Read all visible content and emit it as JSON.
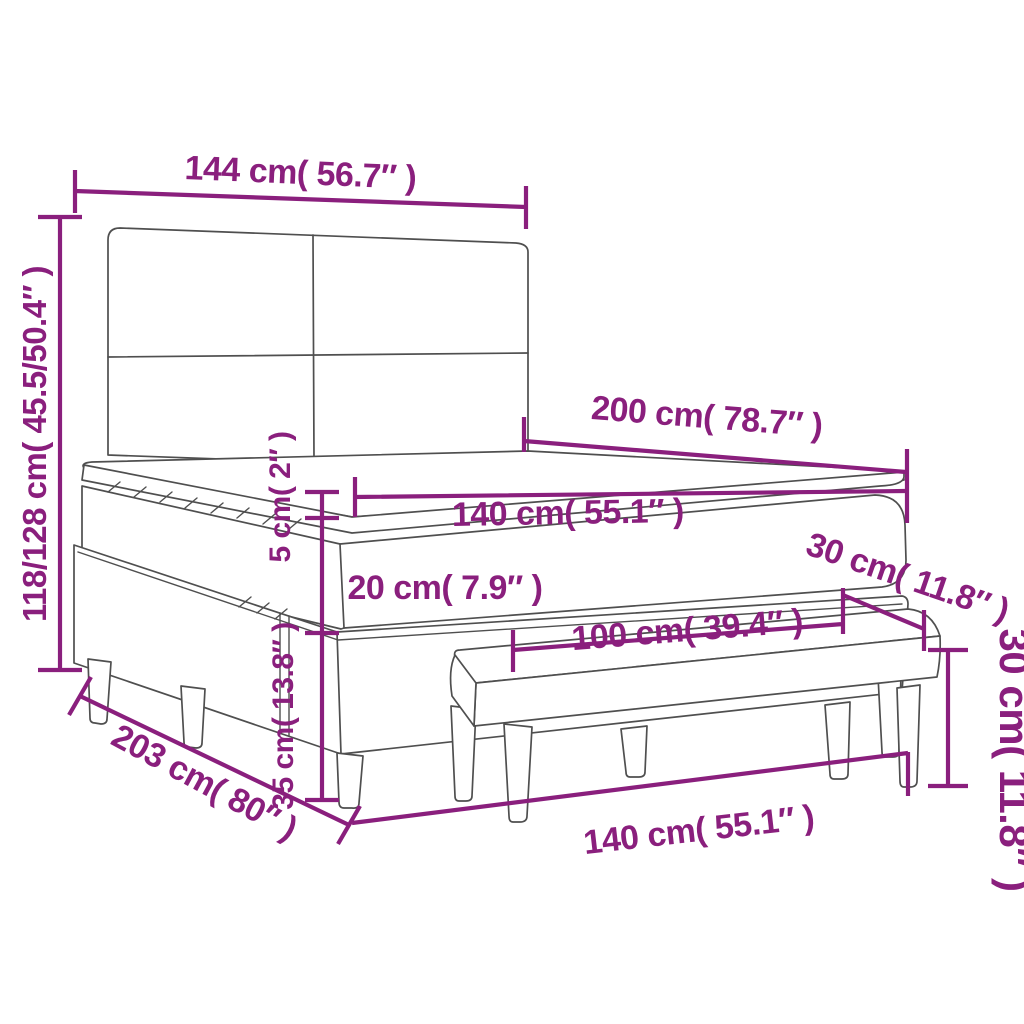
{
  "colors": {
    "annotation": "#8a1f7d",
    "line_art": "#4f4f4f",
    "background": "#ffffff"
  },
  "dims": {
    "headboard_width": "144 cm( 56.7″ )",
    "bed_height": "118/128 cm( 45.5/50.4″ )",
    "bed_length": "200 cm( 78.7″ )",
    "mattress_width": "140 cm( 55.1″ )",
    "topper_height": "5 cm( 2″ )",
    "mattress_height": "20 cm( 7.9″ )",
    "bench_depth": "30 cm( 11.8″ )",
    "bench_length": "100 cm( 39.4″ )",
    "base_height": "35 cm( 13.8″ )",
    "base_length": "203 cm( 80″ )",
    "bed_foot_width": "140 cm( 55.1″ )",
    "bench_height": "30 cm( 11.8″ )"
  }
}
